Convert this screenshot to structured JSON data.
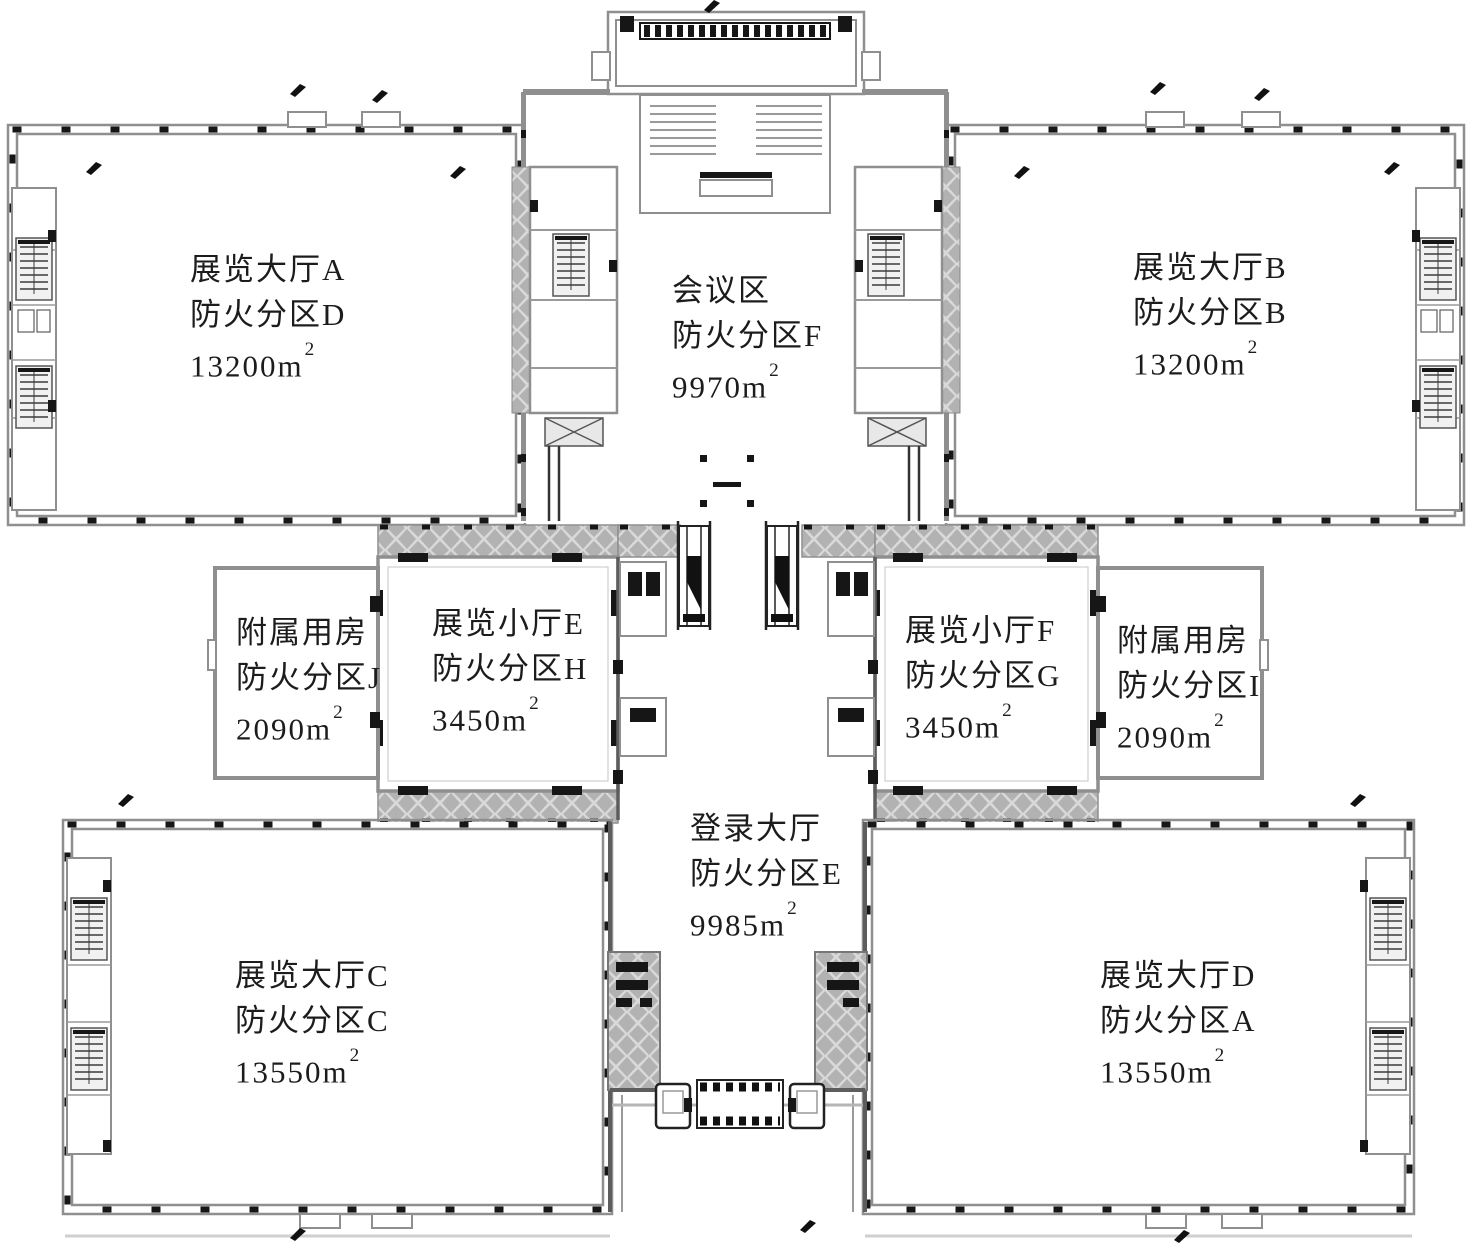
{
  "rooms": [
    {
      "id": "hall-a",
      "name": "展览大厅A",
      "zone": "防火分区D",
      "area_base": "13200m",
      "area_sup": "2"
    },
    {
      "id": "conference",
      "name": "会议区",
      "zone": "防火分区F",
      "area_base": "9970m",
      "area_sup": "2"
    },
    {
      "id": "hall-b",
      "name": "展览大厅B",
      "zone": "防火分区B",
      "area_base": "13200m",
      "area_sup": "2"
    },
    {
      "id": "aux-j",
      "name": "附属用房",
      "zone": "防火分区J",
      "area_base": "2090m",
      "area_sup": "2"
    },
    {
      "id": "small-e",
      "name": "展览小厅E",
      "zone": "防火分区H",
      "area_base": "3450m",
      "area_sup": "2"
    },
    {
      "id": "small-f",
      "name": "展览小厅F",
      "zone": "防火分区G",
      "area_base": "3450m",
      "area_sup": "2"
    },
    {
      "id": "aux-i",
      "name": "附属用房",
      "zone": "防火分区I",
      "area_base": "2090m",
      "area_sup": "2"
    },
    {
      "id": "lobby",
      "name": "登录大厅",
      "zone": "防火分区E",
      "area_base": "9985m",
      "area_sup": "2"
    },
    {
      "id": "hall-c",
      "name": "展览大厅C",
      "zone": "防火分区C",
      "area_base": "13550m",
      "area_sup": "2"
    },
    {
      "id": "hall-d",
      "name": "展览大厅D",
      "zone": "防火分区A",
      "area_base": "13550m",
      "area_sup": "2"
    }
  ],
  "colors": {
    "wall_gray": "#8f8f8f",
    "wall_dark": "#161616",
    "hatch_bg": "#d9d9d9",
    "hatch_diamond": "#b2b2b2",
    "background": "#ffffff",
    "text": "#1c1c1c"
  }
}
